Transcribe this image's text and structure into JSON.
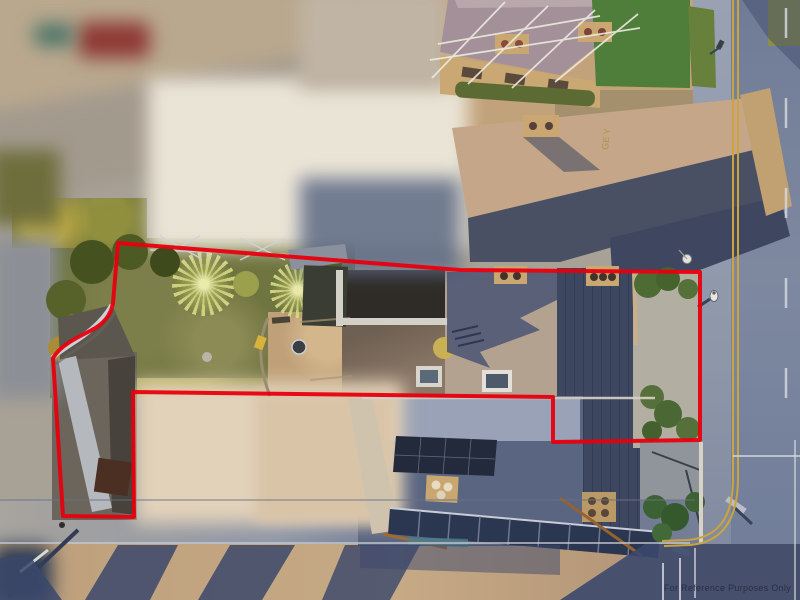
{
  "meta": {
    "image_type": "aerial-drone-photograph",
    "subject": "property with red title-boundary overlay, garden, slate-roofed buildings and adjacent road"
  },
  "watermark": {
    "text": "For Reference Purposes Only",
    "color": "#262d40"
  },
  "boundary": {
    "color": "#e8000e",
    "stroke_width": 4,
    "path": "M118 243 L460 270 L700 272 L700 440 L553 442 L553 397 L133 392 L134 517 L63 516 L53 358 C60 346 76 338 90 331 C104 324 111 315 113 303 Z"
  },
  "road_paint": {
    "letters": "GE Y",
    "color": "#b08f35"
  },
  "palette": {
    "boundary_red": "#e8000e",
    "road_asphalt": "#76819b",
    "road_warm_tan": "#c3a47e",
    "slate_shadow": "#4b5575",
    "slate_sunlit": "#b3a290",
    "sandstone": "#c5a688",
    "lawn_green": "#6f7540",
    "palm_yellow_green": "#d9d98e",
    "hedge_gold": "#9a984c",
    "gravel": "#b3aea2",
    "solar_panel_navy": "#232a3c",
    "double_yellow_line": "#caa43e"
  },
  "scene": {
    "labels": [
      "red property boundary outline",
      "rear garden lawn with two cordyline palms",
      "stone patio with round table",
      "flat-roof extension with skylight",
      "main slate roof with rooflight and chimney pots",
      "solar panel array on front roof",
      "row of glazed roof panels",
      "gravel side yard with shrubs",
      "narrow driveway strip to street",
      "road with double yellow lines and pedestrian",
      "blurred neighbouring buildings and vehicles",
      "long evening building shadows on road"
    ]
  }
}
